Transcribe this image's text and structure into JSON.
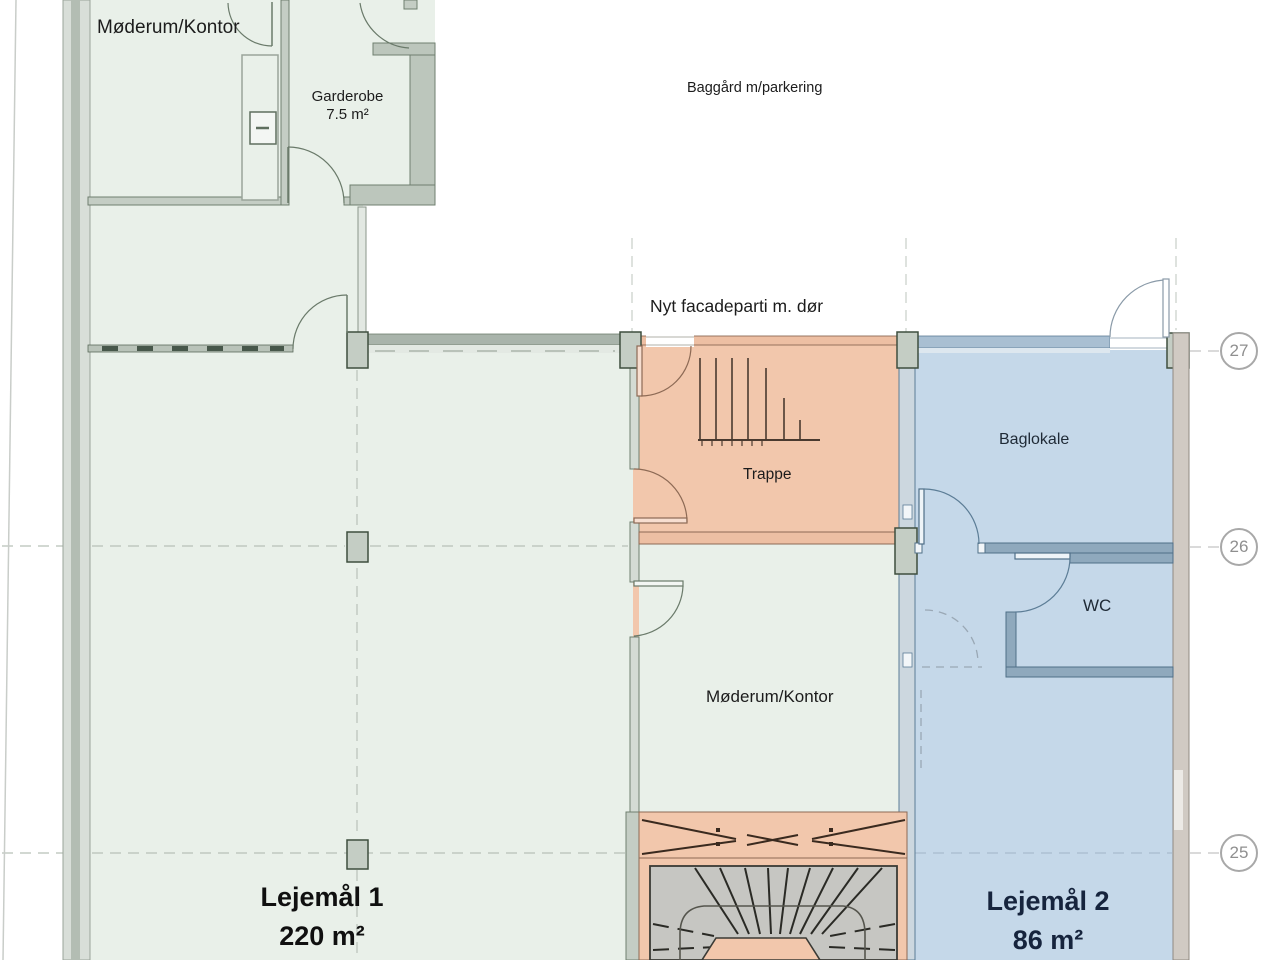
{
  "plan_title": "Floor plan with two tenancies",
  "colors": {
    "tenancy1_fill": "#e9f0e9",
    "tenancy2_fill": "#c5d8e9",
    "stair_zone_fill": "#f2c7ac",
    "wall_gray_fill": "#c4cdc4",
    "wall_blue_line": "#5c7d96",
    "wall_brown_line": "#8d6a55",
    "grid_bubble_gray": "#a8a8a8"
  },
  "rooms": {
    "moderum_top": {
      "label": "Møderum/Kontor"
    },
    "garderobe": {
      "label": "Garderobe",
      "area": "7.5 m²"
    },
    "baggard": {
      "label": "Baggård m/parkering"
    },
    "facade_note": {
      "label": "Nyt facadeparti m. dør"
    },
    "trappe": {
      "label": "Trappe"
    },
    "baglokale": {
      "label": "Baglokale"
    },
    "wc": {
      "label": "WC"
    },
    "moderum_center": {
      "label": "Møderum/Kontor"
    },
    "lejemaal1": {
      "label": "Lejemål 1",
      "area": "220 m²"
    },
    "lejemaal2": {
      "label": "Lejemål 2",
      "area": "86 m²"
    }
  },
  "grid": {
    "bubbles": [
      {
        "label": "27"
      },
      {
        "label": "26"
      },
      {
        "label": "25"
      }
    ]
  }
}
